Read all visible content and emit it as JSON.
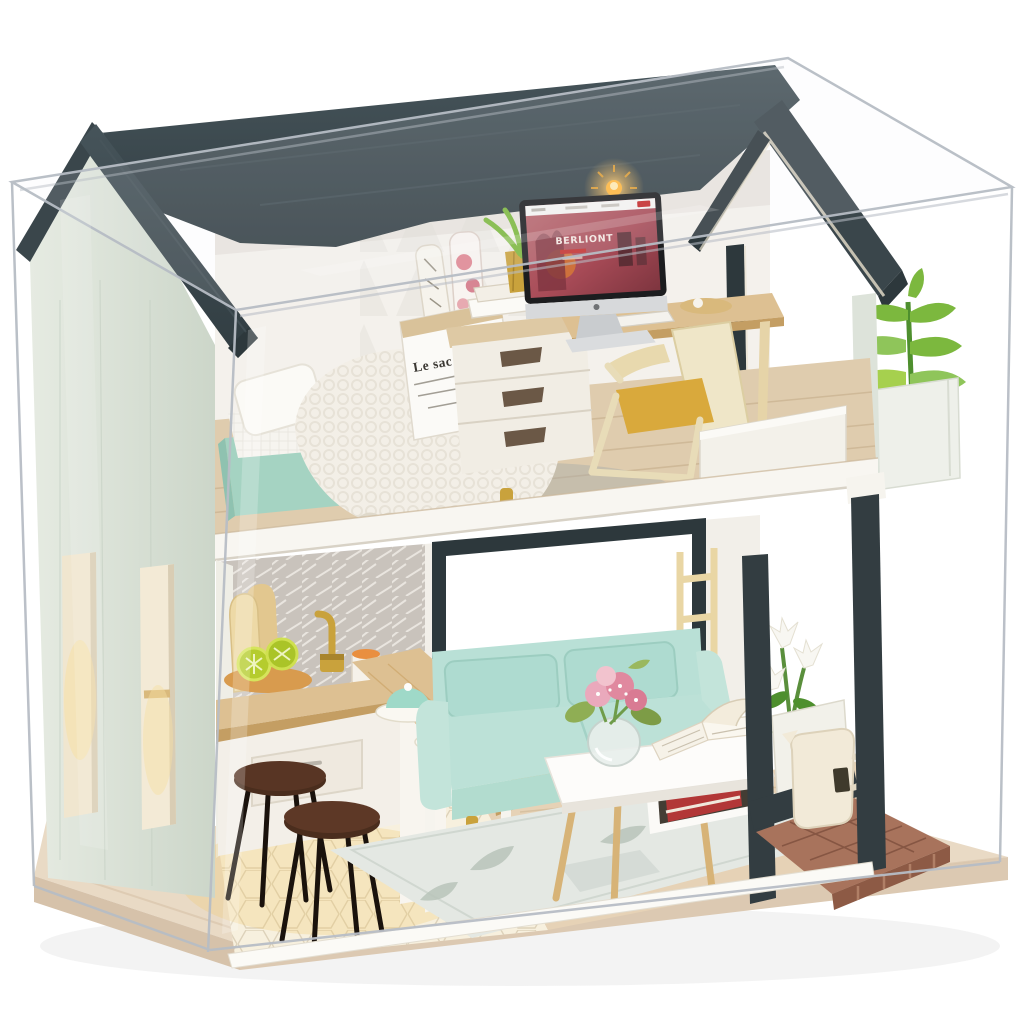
{
  "texts": {
    "bag_title": "Le sac en papier",
    "screen_brand": "BERLIONT"
  },
  "palette": {
    "case-line": "#b7bdc5",
    "roof": "#3a464b",
    "roof-dark": "#2d383c",
    "gable": "#d6dfd2",
    "gable-light": "#e6ebe2",
    "wall": "#f4f1ec",
    "wood": "#ddc092",
    "wood-dark": "#c49e63",
    "floor": "#dfccae",
    "mint": "#a5d3c2",
    "sofa": "#bce1d7",
    "soft-white": "#f7f5f0",
    "gold": "#c9a23c",
    "brick": "#a8735c",
    "brick-dark": "#8d5a45",
    "leaf-green": "#7cb83e",
    "tile": "#ccc7c0",
    "screen-pink": "#a84b57",
    "stool-brown": "#4a2d1d",
    "base-wood": "#e9dac5",
    "base-side": "#d6c2aa",
    "led": "#ffb73e"
  },
  "scene": {
    "description": "DIY miniature dollhouse in clear acrylic display case",
    "upper_room": "bedroom and study with bed, desk, iMac, armchair, balcony planter",
    "lower_room": "kitchen with bar and stools, living room with mint sofa, coffee table, brick patio",
    "light": "warm LED under roof, switched on"
  }
}
